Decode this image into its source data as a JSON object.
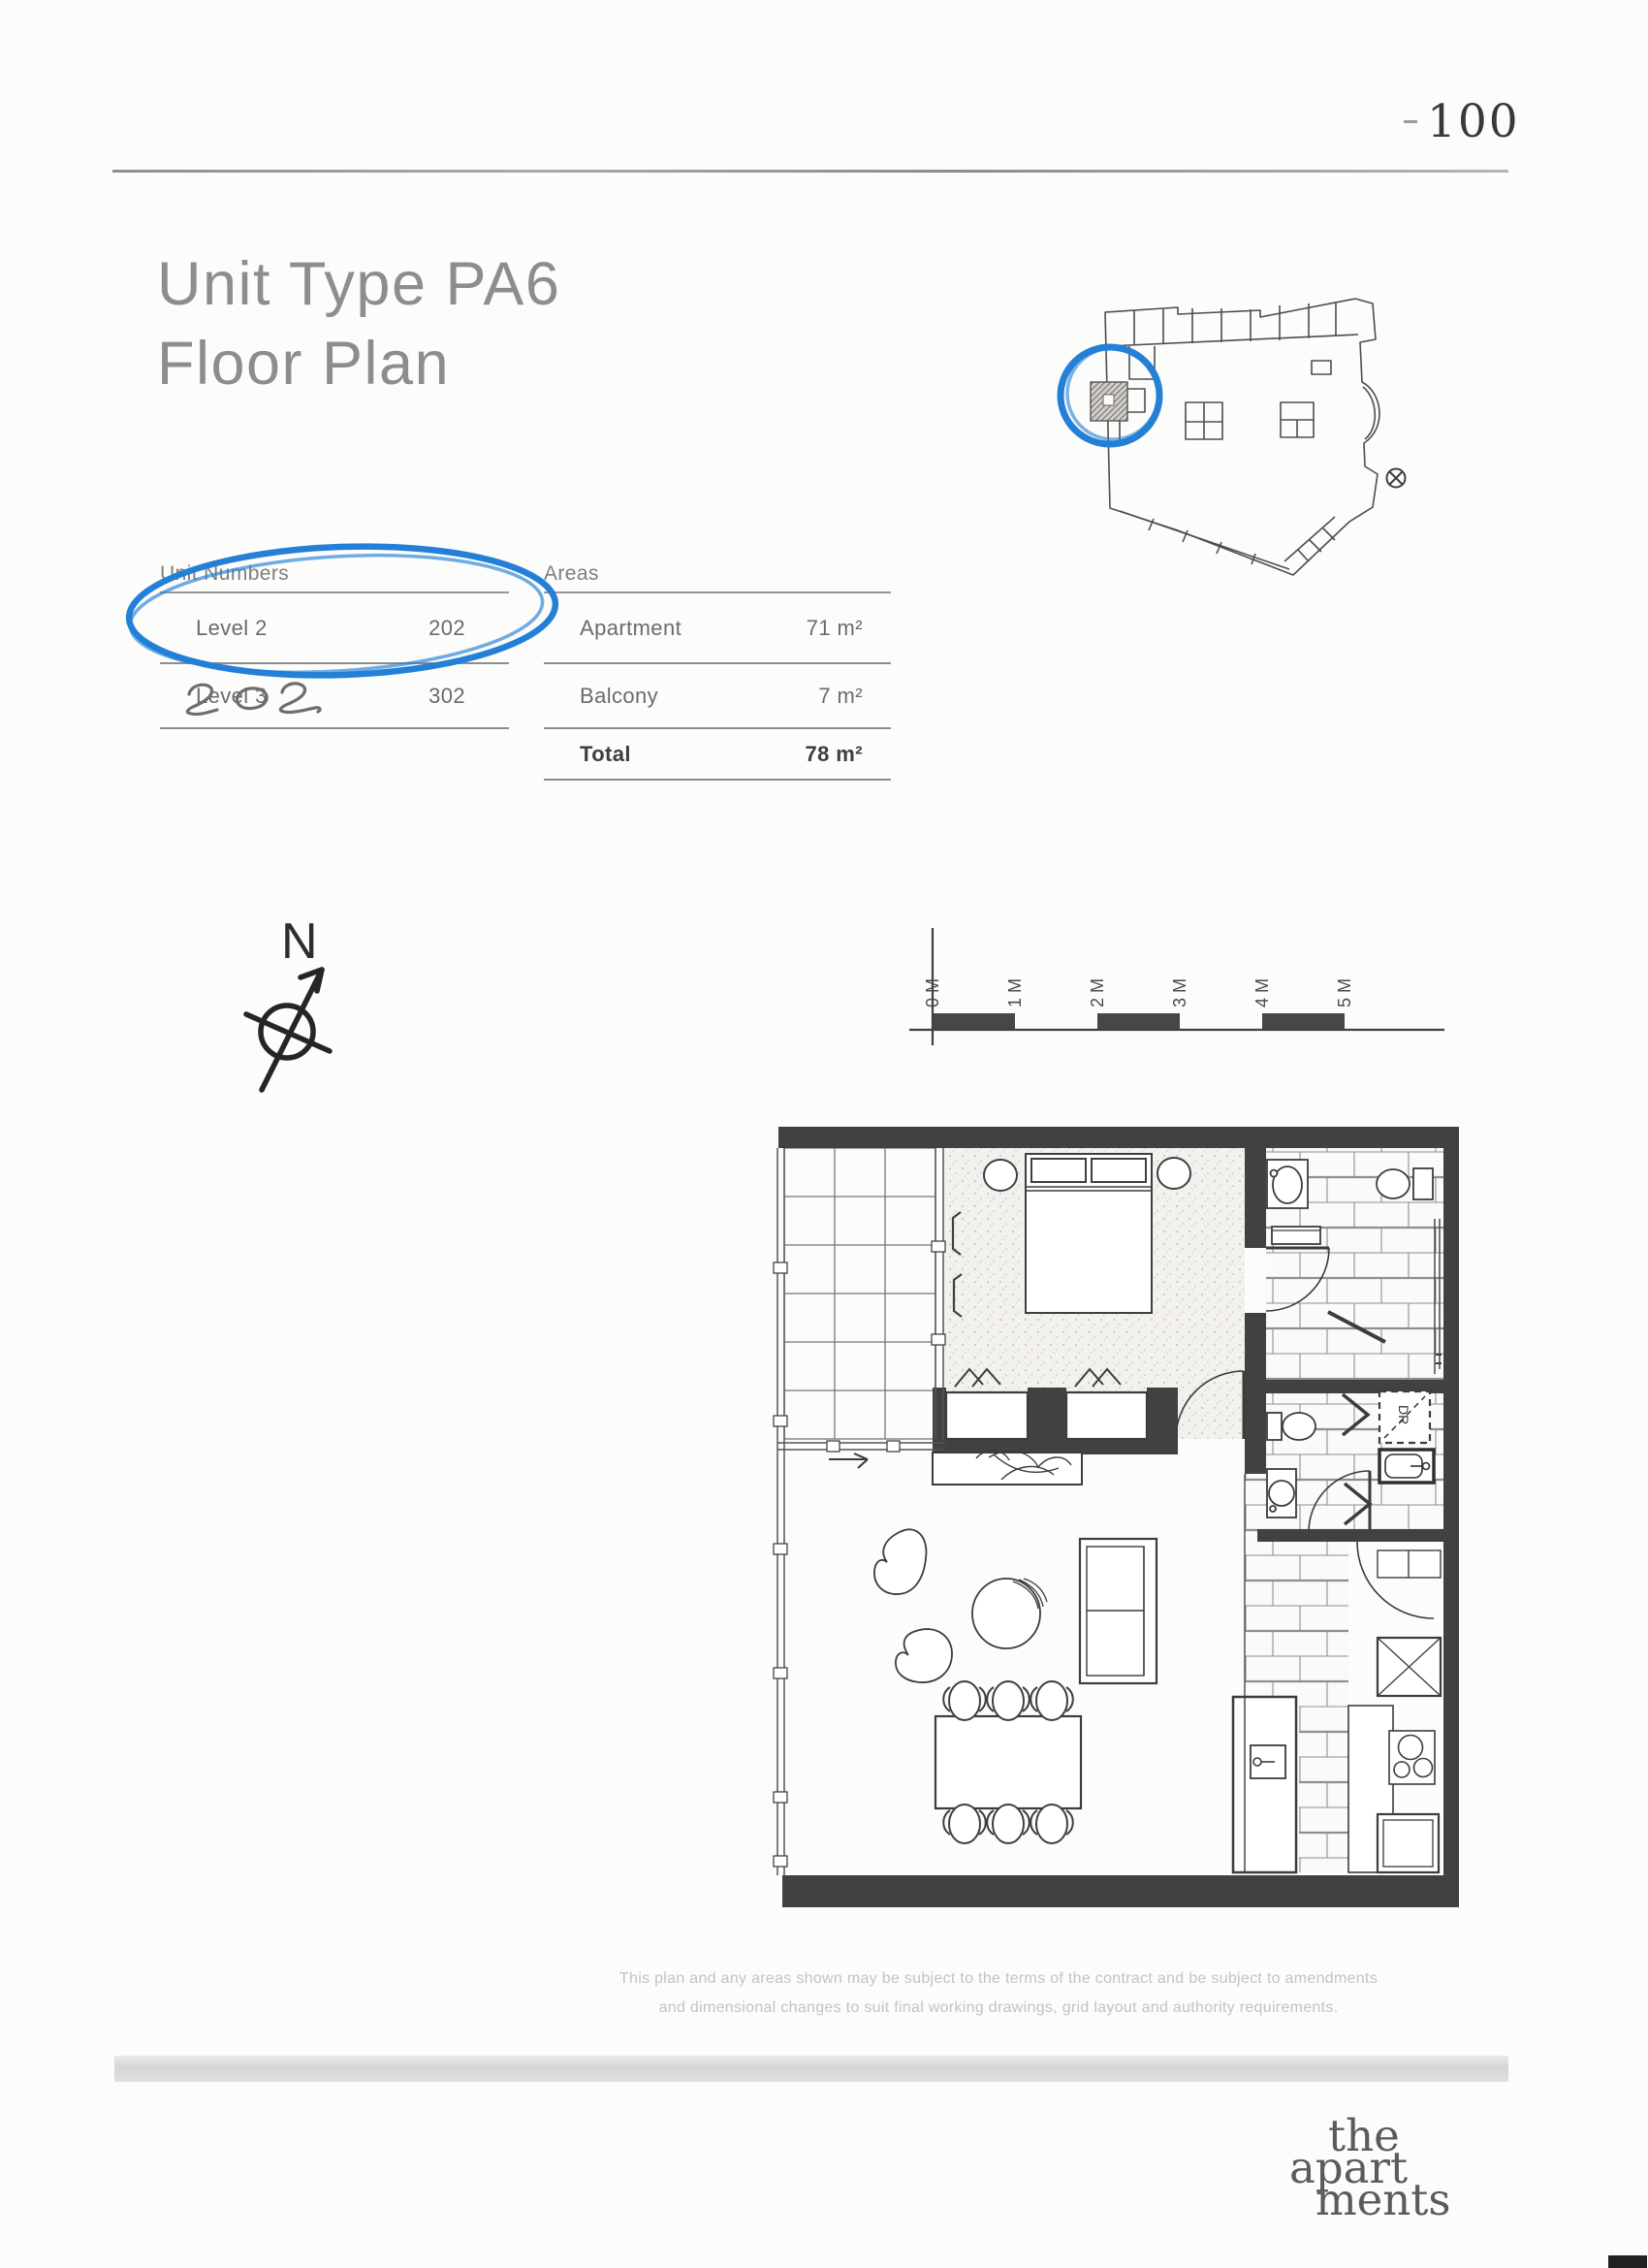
{
  "page": {
    "number": "100"
  },
  "title": {
    "line1": "Unit Type PA6",
    "line2": "Floor Plan"
  },
  "unit_numbers": {
    "header": "Unit Numbers",
    "rows": [
      {
        "label": "Level 2",
        "value": "202"
      },
      {
        "label": "Level 3",
        "value": "302"
      }
    ]
  },
  "areas": {
    "header": "Areas",
    "rows": [
      {
        "label": "Apartment",
        "value": "71 m²"
      },
      {
        "label": "Balcony",
        "value": "7 m²"
      },
      {
        "label": "Total",
        "value": "78 m²"
      }
    ]
  },
  "annotations": {
    "handwritten_unit": "202",
    "pen_color": "#2380d6"
  },
  "compass": {
    "label": "N"
  },
  "scale_bar": {
    "labels": [
      "0 M",
      "1 M",
      "2 M",
      "3 M",
      "4 M",
      "5 M"
    ]
  },
  "floor_plan": {
    "dryer_label": "DR"
  },
  "disclaimer": {
    "line1": "This plan and any areas shown may be subject to the terms of the contract and be subject to amendments",
    "line2": "and dimensional changes to suit final working drawings, grid layout and authority requirements."
  },
  "logo": {
    "word1": "the",
    "word2": "apart",
    "word3": "ments"
  }
}
